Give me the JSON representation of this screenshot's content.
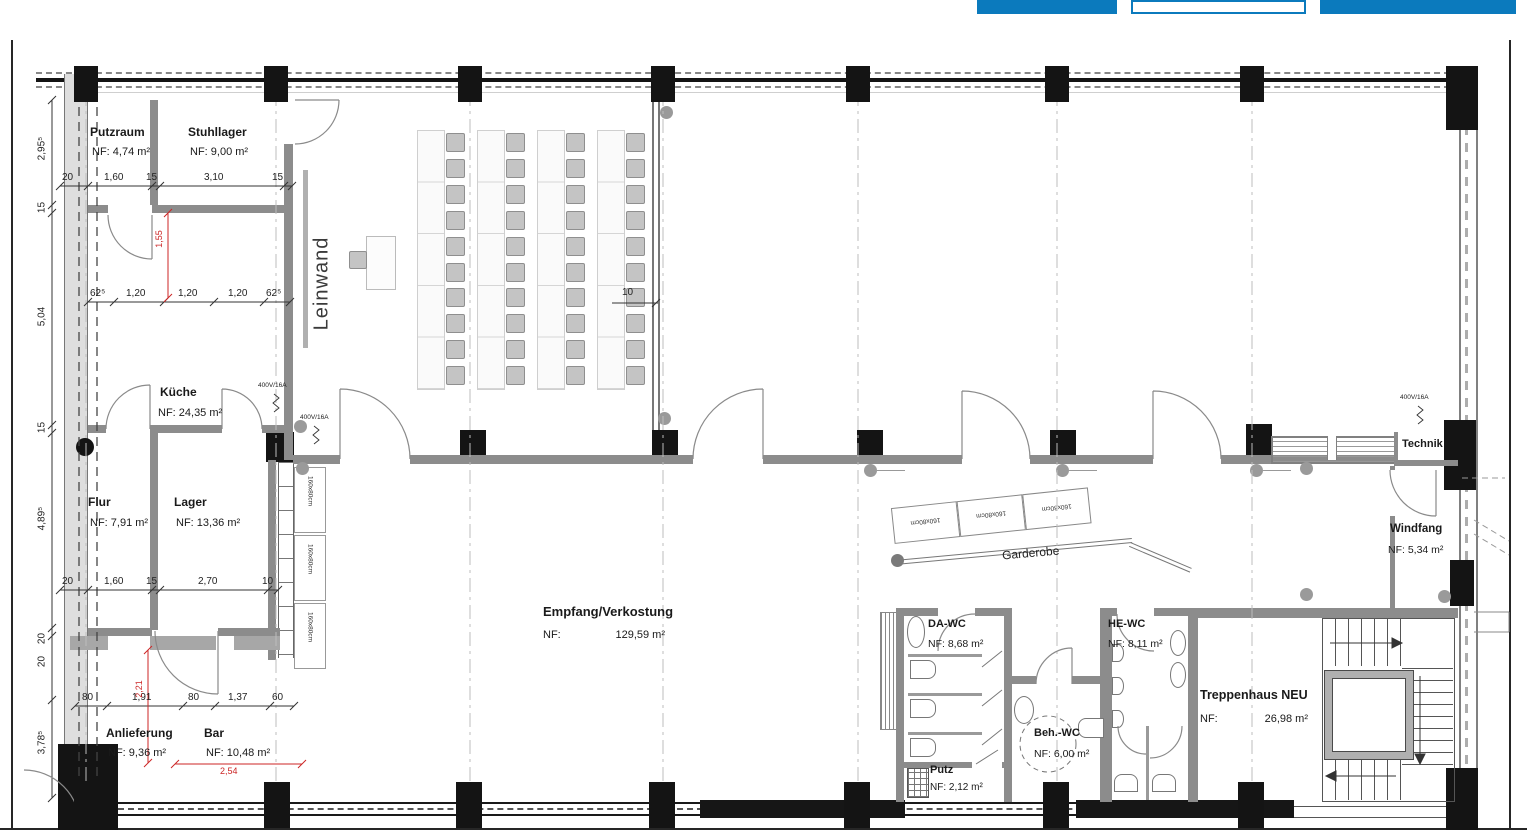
{
  "toolbar": {
    "buttons": [
      {
        "id": "left-blue-button",
        "label": ""
      },
      {
        "id": "center-outline-button",
        "label": ""
      },
      {
        "id": "right-blue-button",
        "label": ""
      }
    ]
  },
  "rooms": {
    "putzraum": {
      "name": "Putzraum",
      "area": "NF: 4,74 m²"
    },
    "stuhllager": {
      "name": "Stuhllager",
      "area": "NF: 9,00 m²"
    },
    "kueche": {
      "name": "Küche",
      "area": "NF: 24,35 m²"
    },
    "flur": {
      "name": "Flur",
      "area": "NF: 7,91 m²"
    },
    "lager": {
      "name": "Lager",
      "area": "NF: 13,36 m²"
    },
    "anlieferung": {
      "name": "Anlieferung",
      "area": "NF: 9,36 m²"
    },
    "bar": {
      "name": "Bar",
      "area": "NF: 10,48 m²"
    },
    "empfang": {
      "name": "Empfang/Verkostung",
      "area_label": "NF:",
      "area_value": "129,59 m²"
    },
    "da_wc": {
      "name": "DA-WC",
      "area": "NF: 8,68 m²"
    },
    "he_wc": {
      "name": "HE-WC",
      "area": "NF: 8,11 m²"
    },
    "beh_wc": {
      "name": "Beh.-WC",
      "area": "NF: 6,00 m²"
    },
    "putz": {
      "name": "Putz",
      "area": "NF: 2,12 m²"
    },
    "treppenhaus": {
      "name": "Treppenhaus NEU",
      "area_label": "NF:",
      "area_value": "26,98 m²"
    },
    "windfang": {
      "name": "Windfang",
      "area": "NF: 5,34 m²"
    },
    "technik": {
      "name": "Technik"
    }
  },
  "annotations": {
    "leinwand": "Leinwand",
    "garderobe": "Garderobe",
    "power": "400V/16A",
    "table_size": "160x80cm"
  },
  "dims": {
    "left_chain": [
      "2,95⁵",
      "15",
      "5,04",
      "15",
      "4,89⁵",
      "20",
      "20",
      "3,78⁵"
    ],
    "top_chain": [
      "20",
      "1,60",
      "15",
      "3,10",
      "15"
    ],
    "kueche_chain": [
      "62⁵",
      "1,20",
      "1,20",
      "1,20",
      "62⁵"
    ],
    "lager_chain": [
      "20",
      "1,60",
      "15",
      "2,70",
      "10"
    ],
    "bar_chain": [
      "80",
      "1,91",
      "80",
      "1,37",
      "60"
    ],
    "partition": "10",
    "red": {
      "r1": "1,55",
      "r2": "2,21",
      "r3": "2,54"
    }
  },
  "furniture": {
    "seat_groups": 4,
    "tables_per_group": 5,
    "chairs_per_group": 10,
    "wardrobe_tables": 3,
    "lager_tables": 3
  },
  "colors": {
    "accent_blue": "#0b7abd",
    "wall_gray": "#8c8c8c",
    "red_dim": "#cc2626"
  }
}
